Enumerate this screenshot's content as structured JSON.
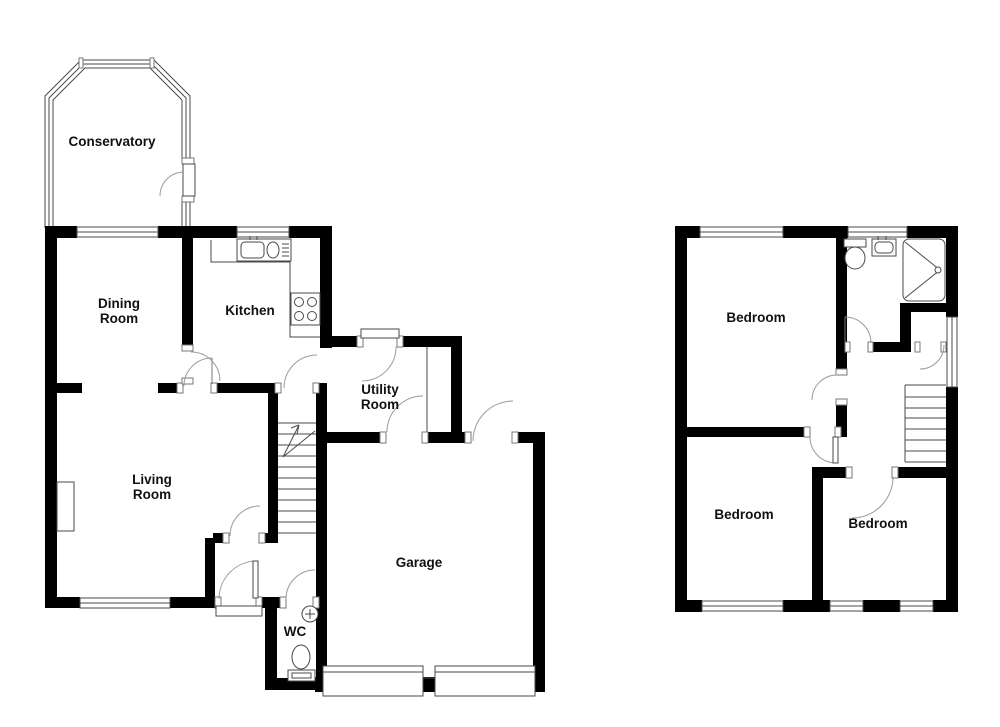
{
  "title": "Floor plan",
  "colors": {
    "wall": "#000000",
    "thin_line": "#4a4a4a",
    "door_arc": "#9a9a9a",
    "background": "#ffffff"
  },
  "ground_floor": {
    "rooms": [
      {
        "id": "conservatory",
        "label": "Conservatory"
      },
      {
        "id": "dining-room",
        "label": "Dining Room"
      },
      {
        "id": "kitchen",
        "label": "Kitchen"
      },
      {
        "id": "utility-room",
        "label": "Utility Room"
      },
      {
        "id": "living-room",
        "label": "Living Room"
      },
      {
        "id": "garage",
        "label": "Garage"
      },
      {
        "id": "wc",
        "label": "WC"
      }
    ],
    "fixtures": [
      "kitchen-sink",
      "kitchen-hob",
      "kitchen-worktop",
      "utility-worktop",
      "wc-toilet",
      "wc-basin",
      "fireplace",
      "staircase-up",
      "garage-door",
      "garage-door",
      "front-door-step"
    ]
  },
  "first_floor": {
    "rooms": [
      {
        "id": "bedroom-1",
        "label": "Bedroom"
      },
      {
        "id": "bedroom-2",
        "label": "Bedroom"
      },
      {
        "id": "bedroom-3",
        "label": "Bedroom"
      }
    ],
    "fixtures": [
      "bathroom-toilet",
      "bathroom-basin",
      "shower-cubicle",
      "staircase",
      "airing-cupboard"
    ]
  }
}
